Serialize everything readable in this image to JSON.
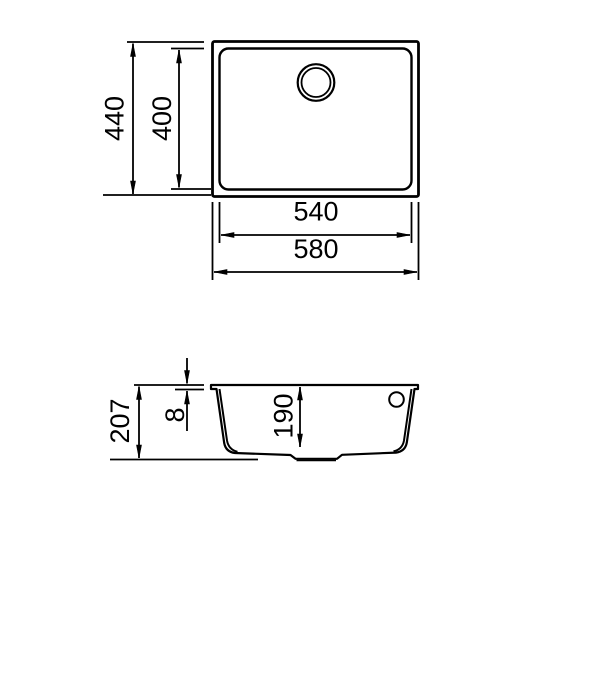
{
  "colors": {
    "background": "#ffffff",
    "line": "#000000",
    "text": "#000000"
  },
  "views": {
    "top": {
      "dimensions": {
        "overall_depth": "440",
        "bowl_depth": "400",
        "bowl_width": "540",
        "overall_width": "580"
      }
    },
    "side": {
      "dimensions": {
        "overall_height": "207",
        "rim_thickness": "8",
        "bowl_inner_depth": "190"
      }
    }
  }
}
